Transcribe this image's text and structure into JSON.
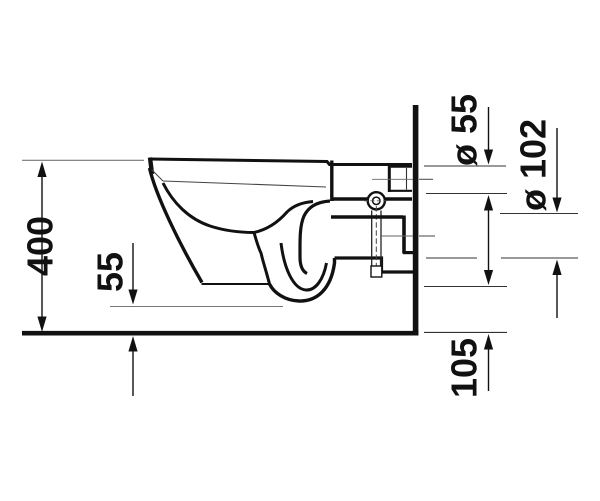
{
  "drawing": {
    "subject": "Wall-hung toilet side-section technical drawing",
    "labels": {
      "height": "400",
      "front_clearance": "55",
      "flush_connection": "ø 55",
      "outlet": "ø 102",
      "underside_height": "105"
    },
    "colors": {
      "ink": "#111111",
      "thin_line": "#7a7a7a",
      "background": "#ffffff"
    }
  }
}
